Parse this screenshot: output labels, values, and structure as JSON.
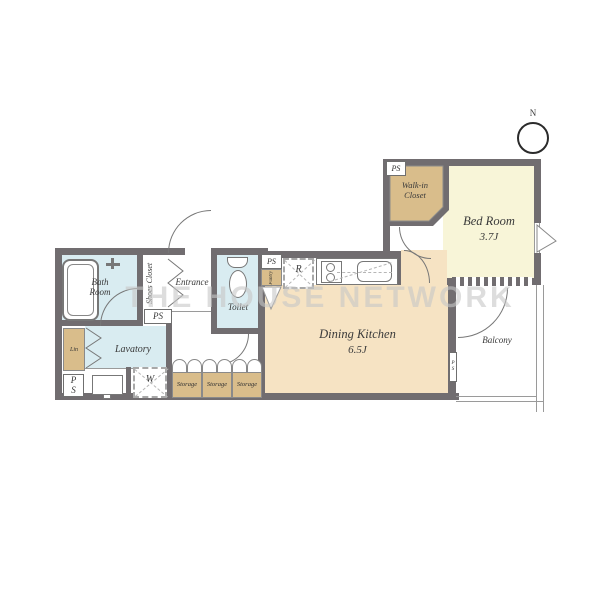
{
  "watermark": "THE HOUSE NETWORK",
  "compass": {
    "north": "N"
  },
  "rooms": {
    "bedroom": {
      "name": "Bed Room",
      "size": "3.7J"
    },
    "walkin_closet": {
      "name": "Walk-in Closet"
    },
    "dining_kitchen": {
      "name": "Dining Kitchen",
      "size": "6.5J"
    },
    "balcony": {
      "name": "Balcony"
    },
    "bath": {
      "name": "Bath Room"
    },
    "lavatory": {
      "name": "Lavatory"
    },
    "toilet": {
      "name": "Toilet"
    },
    "entrance": {
      "name": "Entrance"
    },
    "shoes_closet": {
      "name": "Shoes Closet"
    }
  },
  "labels": {
    "ps": "PS",
    "pantry": "Pantry",
    "lin": "Lin",
    "washer": "W",
    "fridge": "R",
    "storage": "Storage"
  },
  "colors": {
    "wall": "#716d70",
    "tan": "#d9bd8b",
    "yellow": "#f8f5d8",
    "peach": "#f6e3c3",
    "blue": "#d9ecf1",
    "line": "#777777"
  }
}
